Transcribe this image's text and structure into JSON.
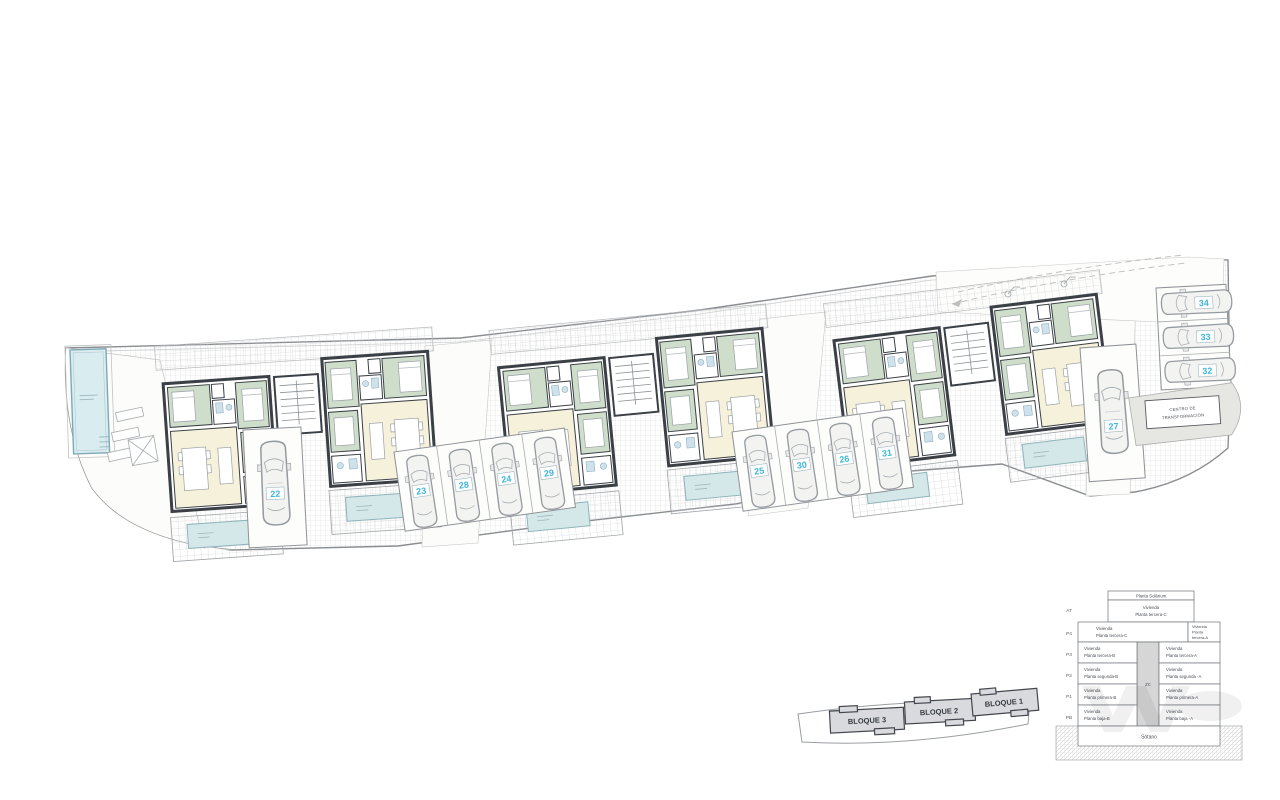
{
  "plan": {
    "type_hint": "residential site plan with three blocks, parking and pools"
  },
  "parking": {
    "spaces": [
      {
        "num": "22"
      },
      {
        "num": "23"
      },
      {
        "num": "28"
      },
      {
        "num": "24"
      },
      {
        "num": "29"
      },
      {
        "num": "25"
      },
      {
        "num": "30"
      },
      {
        "num": "26"
      },
      {
        "num": "31"
      },
      {
        "num": "27"
      },
      {
        "num": "32"
      },
      {
        "num": "33"
      },
      {
        "num": "34"
      }
    ]
  },
  "transformer": {
    "line1": "CENTRO DE",
    "line2": "TRANSFORMACIÓN"
  },
  "keyplan": {
    "blocks": [
      {
        "label": "BLOQUE 3"
      },
      {
        "label": "BLOQUE 2"
      },
      {
        "label": "BLOQUE 1"
      }
    ]
  },
  "legend": {
    "solarium": "Planta Solárium",
    "unit_word": "Vivienda",
    "axis": [
      "AT",
      "P4",
      "P3",
      "P2",
      "P1",
      "PB"
    ],
    "at_floor": "Planta tercera-C",
    "p4_left_floor": "Planta tercera-C",
    "p4_right": [
      "Vivienda",
      "Planta",
      "tercera-A"
    ],
    "p3_left": "Planta tercera-B",
    "p3_right": "Planta tercera-A",
    "p2_left": "Planta segunda-B",
    "p2_right": "Planta segunda -A",
    "p1_left": "Planta primera-B",
    "p1_right": "Planta primera-A",
    "pb_left": "Planta baja-B",
    "pb_right": "Planta baja -A",
    "core": "ZC",
    "basement": "Sótano"
  },
  "colors": {
    "parking_number": "#3fb6d8",
    "wall": "#3b4046",
    "bedroom": "#cfdecb",
    "living": "#f6f1da",
    "pool_fill": "#d9ecef",
    "pool_border": "#7fa9b6",
    "keyplan_block": "#d8dadd",
    "hatch_line": "#d6d6d6"
  }
}
